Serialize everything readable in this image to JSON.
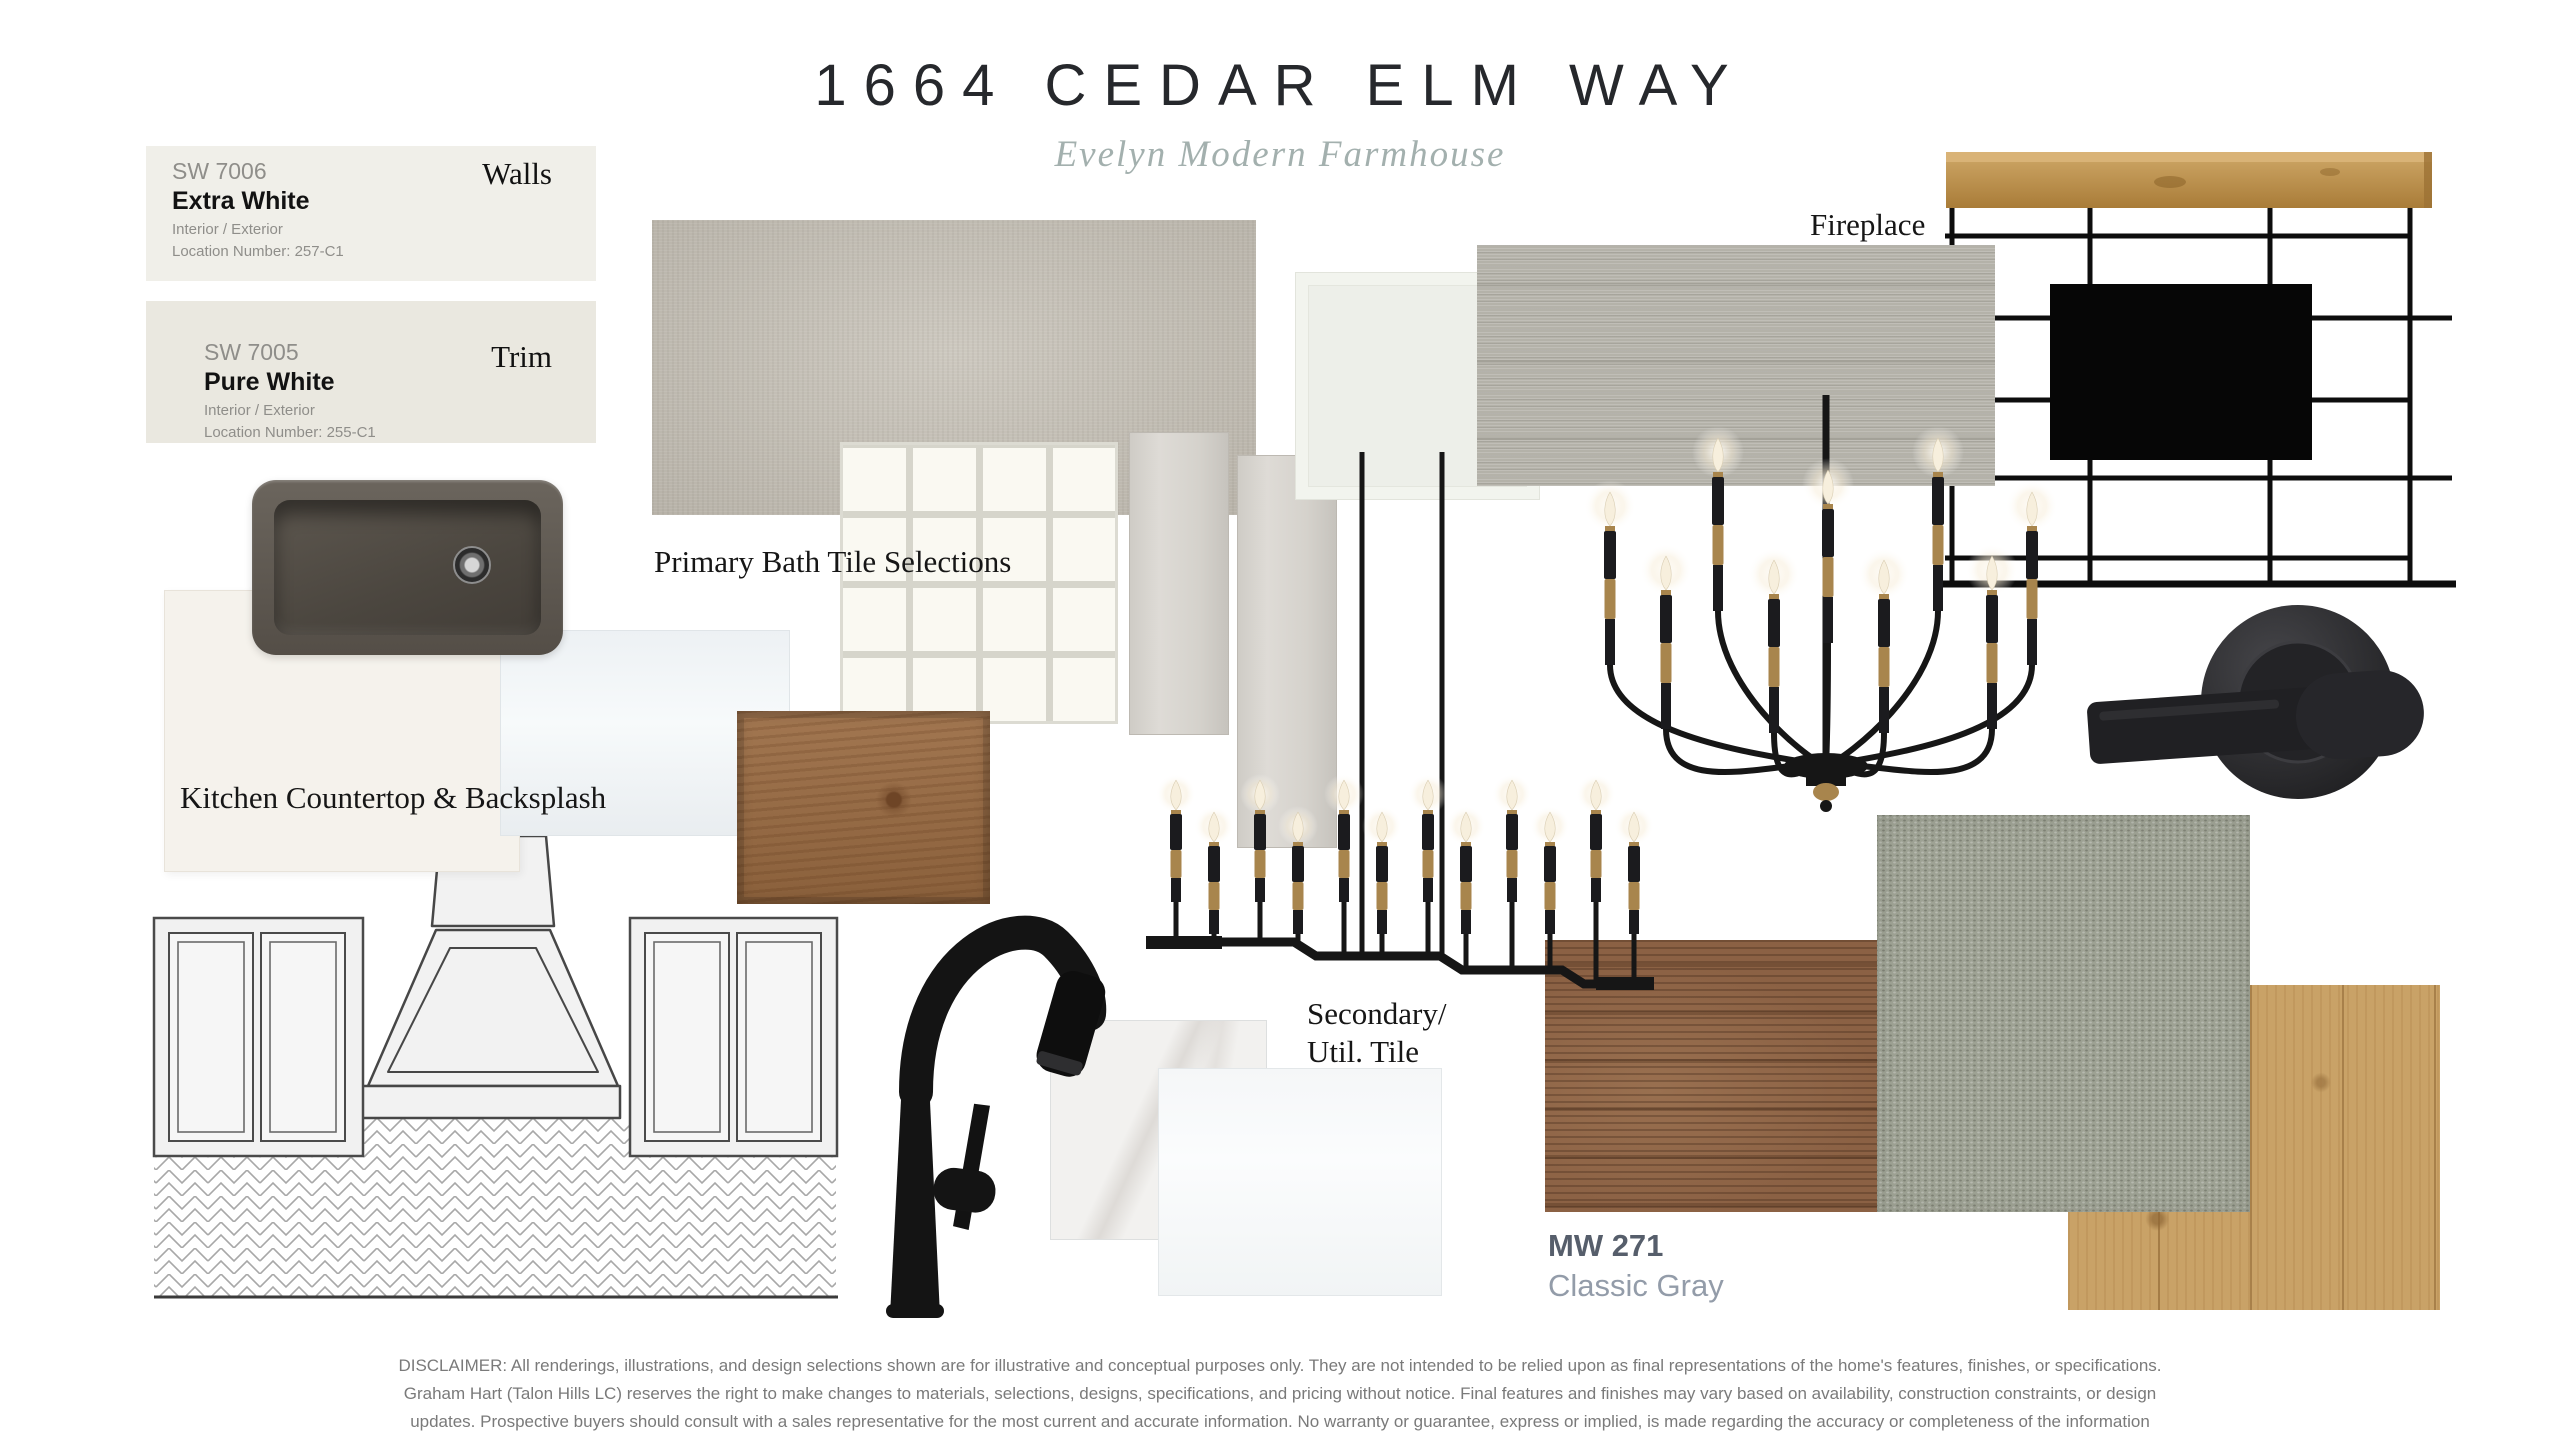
{
  "header": {
    "title": "1664 CEDAR ELM WAY",
    "subtitle": "Evelyn Modern Farmhouse"
  },
  "paint": {
    "swatches": [
      {
        "code": "SW 7006",
        "name": "Extra White",
        "finish": "Interior / Exterior",
        "location": "Location Number: 257-C1",
        "usage_label": "Walls"
      },
      {
        "code": "SW 7005",
        "name": "Pure White",
        "finish": "Interior / Exterior",
        "location": "Location Number: 255-C1",
        "usage_label": "Trim"
      }
    ]
  },
  "section_labels": {
    "primary_bath": "Primary Bath Tile Selections",
    "kitchen": "Kitchen Countertop & Backsplash",
    "fireplace": "Fireplace",
    "secondary_util_line1": "Secondary/",
    "secondary_util_line2": "Util. Tile"
  },
  "stain": {
    "code": "MW 271",
    "name": "Classic Gray"
  },
  "disclaimer": "DISCLAIMER: All renderings, illustrations, and design selections shown are for illustrative and conceptual purposes only. They are not intended to be relied upon as final representations of the home's features, finishes, or specifications. Graham Hart (Talon Hills LC) reserves the right to make changes to materials, selections, designs, specifications, and pricing without notice. Final features and finishes may vary based on availability, construction constraints, or design updates. Prospective buyers should consult with a sales representative for the most current and accurate information. No warranty or guarantee, express or implied, is made regarding the accuracy or completeness of the information presented.",
  "colors": {
    "walls_card_bg": "#f0efe9",
    "trim_card_bg": "#eae8e0",
    "subtitle_accent": "#a3b0ae",
    "matte_black_fixture": "#161616",
    "brass_accent": "#a8854d",
    "linen_tile": "#c7c2b8",
    "woodgrain_tile": "#b4b2a9",
    "cabinet_stain": "#9a6b42",
    "mw271_stain": "#8b6144",
    "carpet": "#9ea294",
    "oak_floor": "#c9a267",
    "mantel_wood": "#b8893f",
    "sink": "#544e47"
  }
}
